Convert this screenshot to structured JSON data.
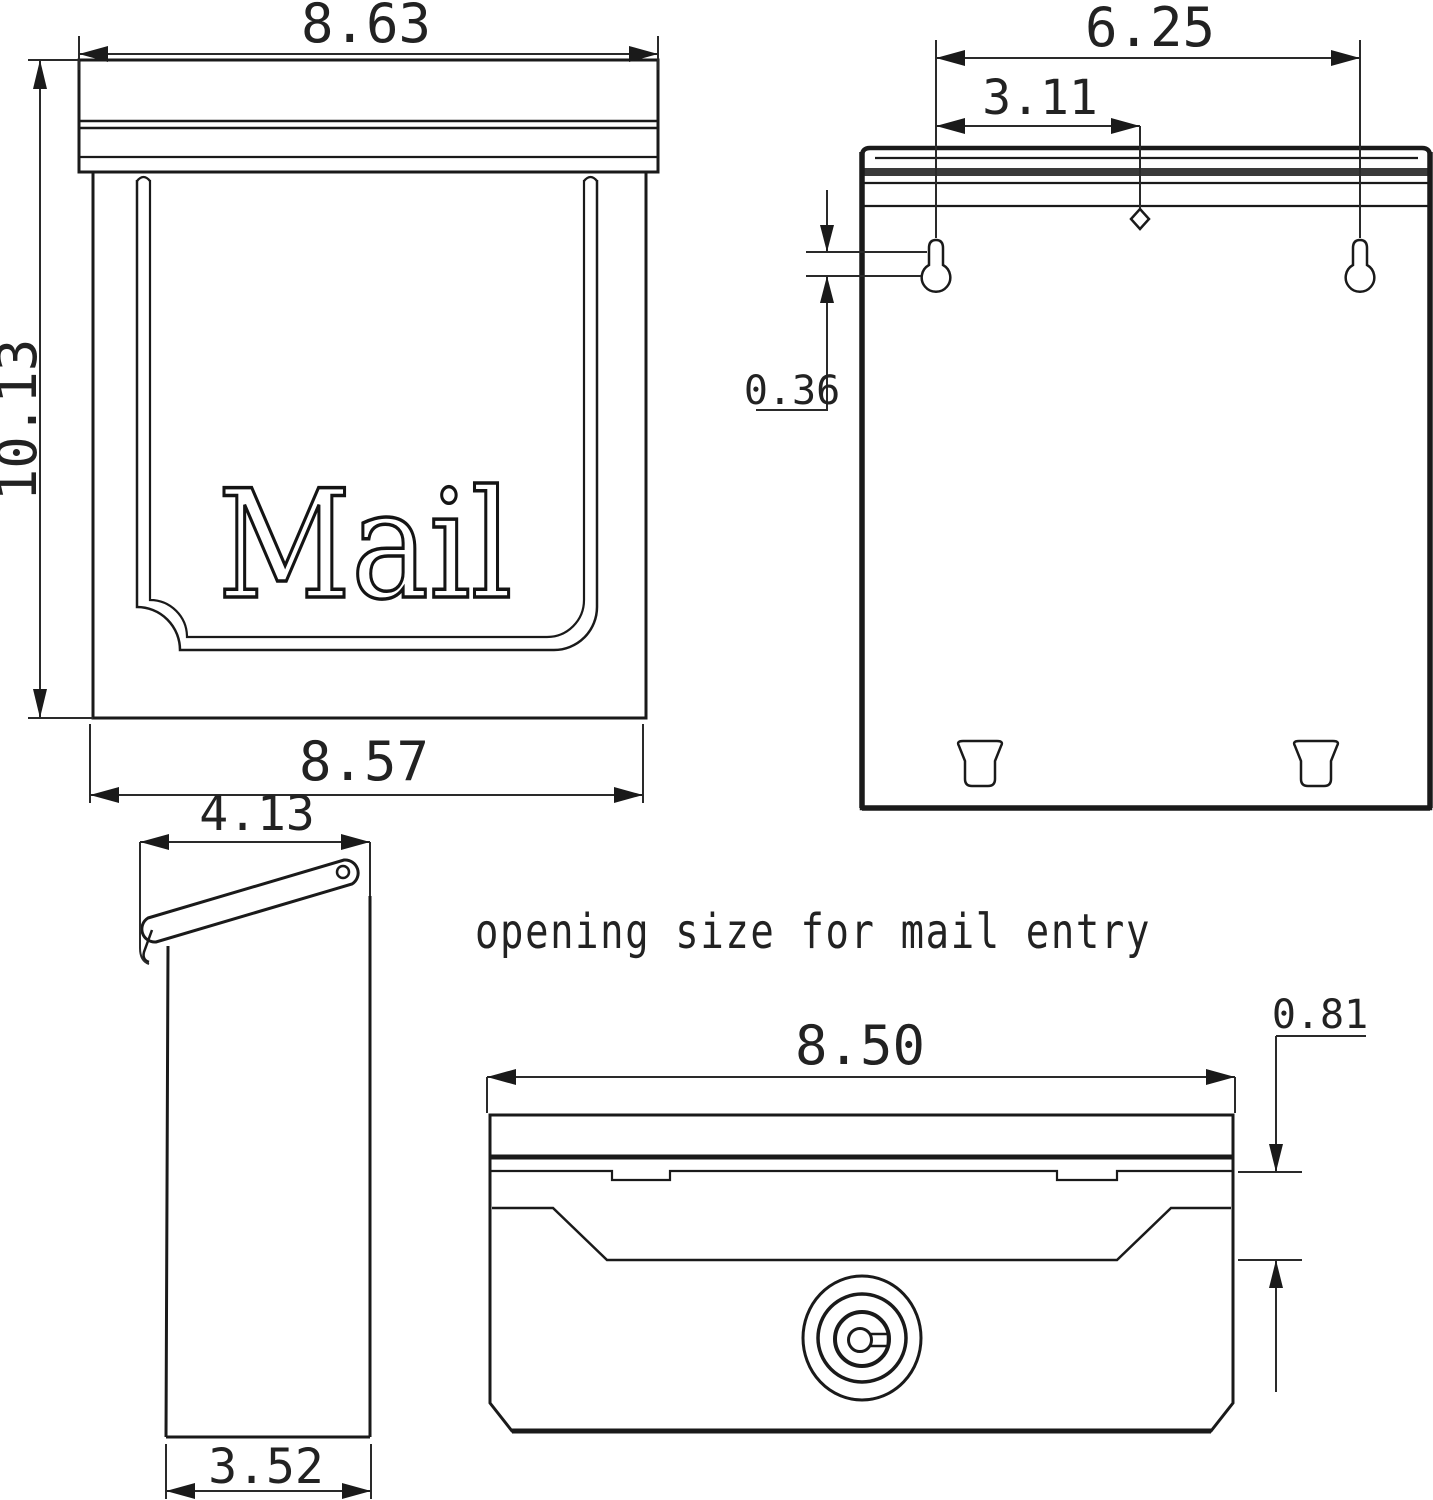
{
  "drawing": {
    "title_annotation": "opening size for mail entry",
    "line_color": "#1a1a1a",
    "background": "#ffffff",
    "front_view": {
      "mail_label": "Mail",
      "top_width": "8.63",
      "height": "10.13",
      "bottom_width": "8.57"
    },
    "back_view": {
      "mount_hole_span": "6.25",
      "hole_to_center": "3.11",
      "keyhole_offset": "0.36"
    },
    "side_view": {
      "top_depth": "4.13",
      "bottom_depth": "3.52"
    },
    "opening_view": {
      "opening_width": "8.50",
      "opening_height": "0.81"
    }
  }
}
